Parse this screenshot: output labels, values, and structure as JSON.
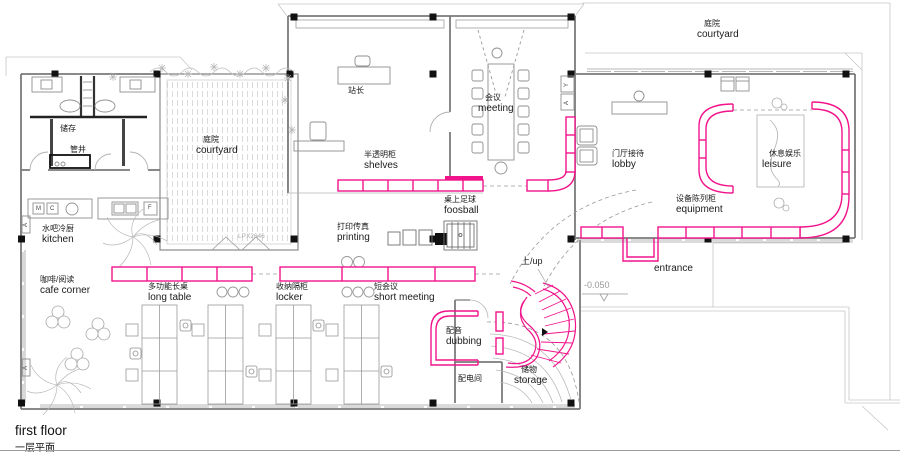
{
  "title": {
    "floor_en": "first floor",
    "floor_zh": "一层平面"
  },
  "colors": {
    "accent": "#F2138B",
    "wall": "#7a7a7a",
    "light": "#c4c4c4",
    "furn": "#909090",
    "ink": "#1a1a1a"
  },
  "rooms": {
    "courtyard_tr": {
      "zh": "庭院",
      "en": "courtyard"
    },
    "courtyard_left": {
      "zh": "庭院",
      "en": "courtyard"
    },
    "station_master": {
      "zh": "站长"
    },
    "meeting": {
      "zh": "会议",
      "en": "meeting"
    },
    "store": {
      "zh": "储存"
    },
    "pipe_shaft": {
      "zh": "管井"
    },
    "shelves": {
      "zh": "半透明柜",
      "en": "shelves"
    },
    "lobby": {
      "zh": "门厅接待",
      "en": "lobby"
    },
    "leisure": {
      "zh": "休息娱乐",
      "en": "leisure"
    },
    "foosball": {
      "zh": "桌上足球",
      "en": "foosball"
    },
    "equipment": {
      "zh": "设备陈列柜",
      "en": "equipment"
    },
    "printing": {
      "zh": "打印传真",
      "en": "printing"
    },
    "kitchen": {
      "zh": "水吧冷厨",
      "en": "kitchen"
    },
    "cafe_corner": {
      "zh": "咖啡/阅读",
      "en": "cafe corner"
    },
    "long_table": {
      "zh": "多功能长桌",
      "en": "long table"
    },
    "locker": {
      "zh": "收纳隔柜",
      "en": "locker"
    },
    "short_meeting": {
      "zh": "短会议",
      "en": "short meeting"
    },
    "up": {
      "zh": "上/up"
    },
    "entrance": {
      "en": "entrance"
    },
    "dubbing": {
      "zh": "配音",
      "en": "dubbing"
    },
    "electrical": {
      "zh": "配电间"
    },
    "storage": {
      "zh": "储物",
      "en": "storage"
    }
  },
  "annotations": {
    "elevation": "-0.050",
    "window_code": "LPX2646",
    "letters": {
      "m": "M",
      "c": "C",
      "f": "F",
      "a": "A",
      "y": "Y"
    }
  }
}
